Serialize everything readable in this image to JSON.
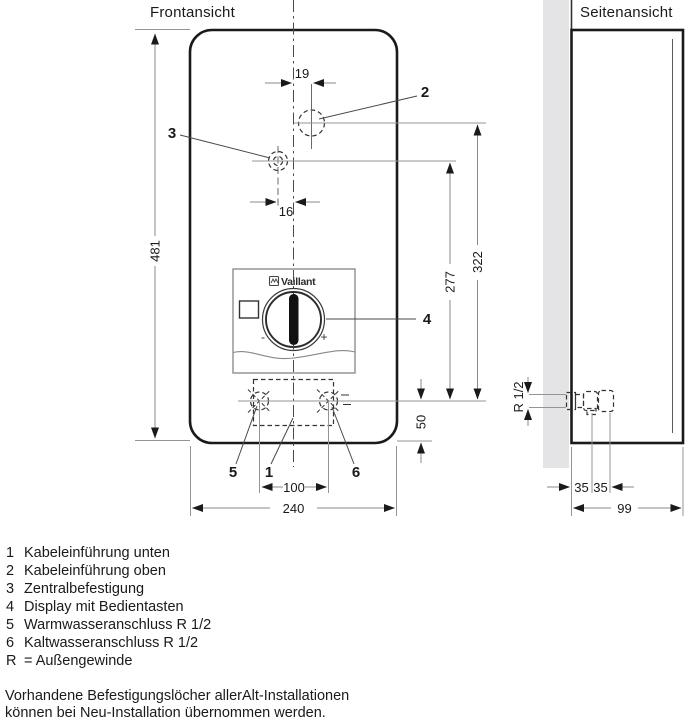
{
  "views": {
    "front_title": "Frontansicht",
    "side_title": "Seitenansicht"
  },
  "brand": {
    "name": "Vaillant"
  },
  "control_panel": {
    "minus_label": "-",
    "plus_label": "+"
  },
  "dimensions": {
    "front_height": "481",
    "front_width": "240",
    "top_hole_offset": "19",
    "center_hole_offset": "16",
    "top_hole_from_connections": "322",
    "center_hole_from_connections": "277",
    "connections_from_bottom": "50",
    "connection_spacing": "100",
    "thread_size": "R 1/2",
    "side_offset_a": "35",
    "side_offset_b": "35",
    "side_depth": "99"
  },
  "callouts": {
    "c1": "1",
    "c2": "2",
    "c3": "3",
    "c4": "4",
    "c5": "5",
    "c6": "6"
  },
  "legend": {
    "items": [
      {
        "key": "1",
        "label": "Kabeleinführung unten"
      },
      {
        "key": "2",
        "label": "Kabeleinführung oben"
      },
      {
        "key": "3",
        "label": "Zentralbefestigung"
      },
      {
        "key": "4",
        "label": "Display mit Bedientasten"
      },
      {
        "key": "5",
        "label": "Warmwasseranschluss R 1/2"
      },
      {
        "key": "6",
        "label": "Kaltwasseranschluss R 1/2"
      },
      {
        "key": "R",
        "label": "= Außengewinde"
      }
    ]
  },
  "note": {
    "line1": "Vorhandene Befestigungslöcher allerAlt-Installationen",
    "line2": "können bei Neu-Installation übernommen werden."
  },
  "colors": {
    "outline": "#1a1a1a",
    "dim_line": "#8a8a8a",
    "extension_line": "#949494",
    "arrow": "#1a1a1a",
    "wall_fill": "#e4e4e6",
    "panel_border": "#8f8f8f",
    "knob": "#111111",
    "text": "#1a1a1a",
    "background": "#ffffff"
  }
}
